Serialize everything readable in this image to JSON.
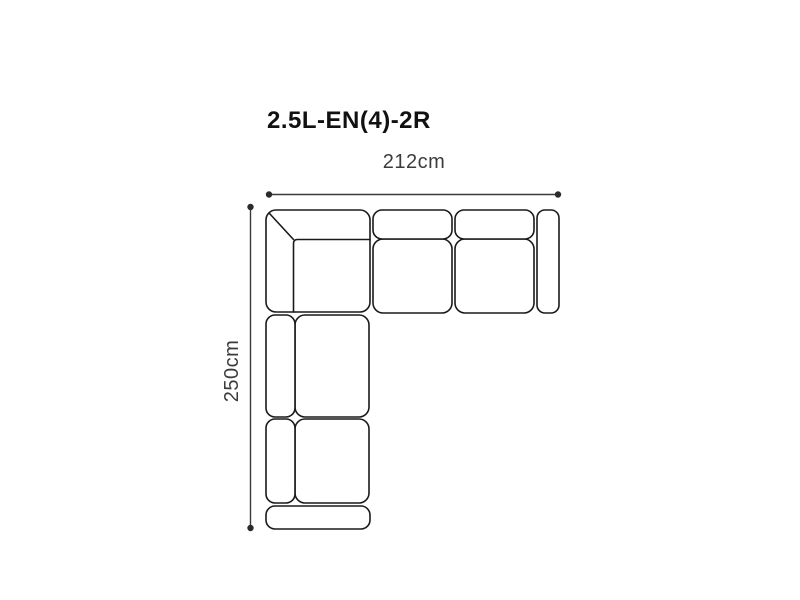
{
  "diagram": {
    "title": "2.5L-EN(4)-2R",
    "width_dimension": {
      "label": "212cm",
      "value": 212,
      "unit": "cm",
      "orientation": "horizontal"
    },
    "height_dimension": {
      "label": "250cm",
      "value": 250,
      "unit": "cm",
      "orientation": "vertical"
    },
    "sofa": {
      "type": "corner-sectional-sofa-top-view",
      "shape": "L-shape",
      "sections": [
        "corner-unit-top-left",
        "seat-unit-middle",
        "seat-unit-right",
        "armrest-right",
        "chaise-seat-upper-left",
        "chaise-seat-lower-left",
        "armrest-front-bottom"
      ]
    },
    "colors": {
      "background": "#ffffff",
      "outline": "#1a1a1a",
      "dimension_line": "#3a3a3a",
      "label_text": "#3c3c3c",
      "title_text": "#111111"
    }
  }
}
